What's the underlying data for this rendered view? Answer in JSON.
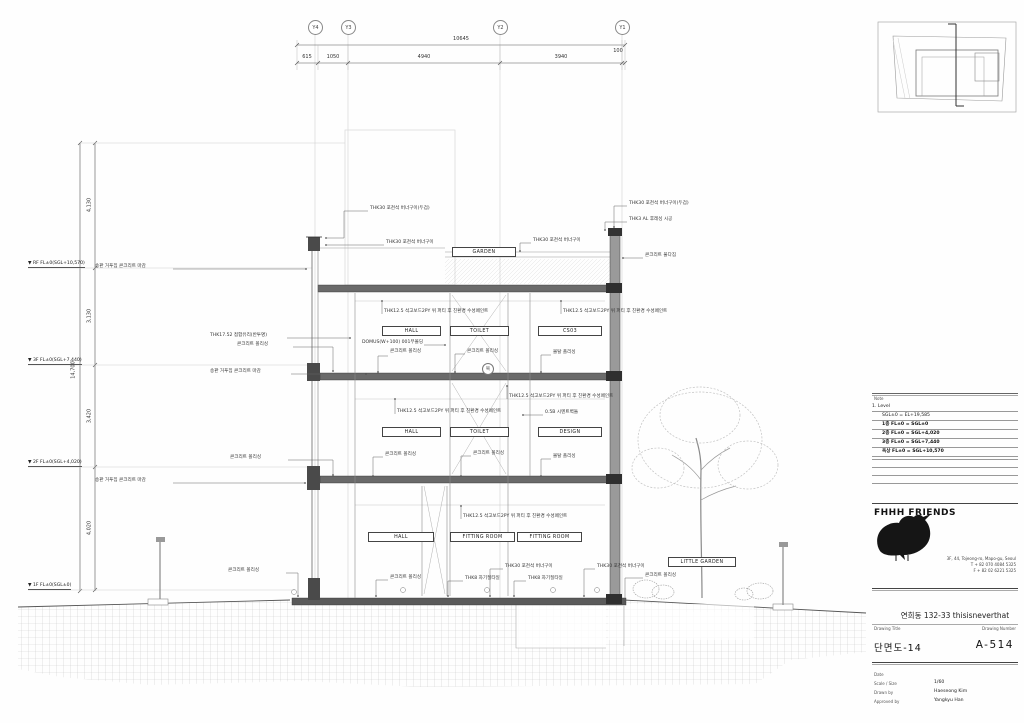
{
  "grid": {
    "bubbles": [
      {
        "x": 315,
        "label": "Y4"
      },
      {
        "x": 348,
        "label": "Y3"
      },
      {
        "x": 500,
        "label": "Y2"
      },
      {
        "x": 622,
        "label": "Y1"
      }
    ]
  },
  "dims": {
    "top": [
      {
        "cx": 461,
        "y": 37,
        "text": "10645"
      },
      {
        "cx": 307,
        "y": 55,
        "text": "615"
      },
      {
        "cx": 333,
        "y": 55,
        "text": "1050"
      },
      {
        "cx": 424,
        "y": 55,
        "text": "4940"
      },
      {
        "cx": 561,
        "y": 55,
        "text": "3940"
      },
      {
        "cx": 618,
        "y": 49,
        "text": "100"
      }
    ],
    "left": [
      {
        "x": 74,
        "cy": 370,
        "text": "14,700"
      },
      {
        "x": 90,
        "cy": 205,
        "text": "4,130"
      },
      {
        "x": 90,
        "cy": 316,
        "text": "3,130"
      },
      {
        "x": 90,
        "cy": 416,
        "text": "3,420"
      },
      {
        "x": 90,
        "cy": 528,
        "text": "4,020"
      }
    ]
  },
  "levels": [
    {
      "y": 268,
      "text": "RF FL±0(SGL+10,570)"
    },
    {
      "y": 365,
      "text": "3F FL±0(SGL+7,440)"
    },
    {
      "y": 467,
      "text": "2F FL±0(SGL+4,020)"
    },
    {
      "y": 590,
      "text": "1F FL±0(SGL±0)"
    }
  ],
  "rooms": [
    {
      "x": 452,
      "y": 247,
      "w": 62,
      "text": "GARDEN"
    },
    {
      "x": 382,
      "y": 326,
      "w": 57,
      "text": "HALL"
    },
    {
      "x": 450,
      "y": 326,
      "w": 57,
      "text": "TOILET"
    },
    {
      "x": 538,
      "y": 326,
      "w": 62,
      "text": "CS03"
    },
    {
      "x": 382,
      "y": 427,
      "w": 57,
      "text": "HALL"
    },
    {
      "x": 450,
      "y": 427,
      "w": 57,
      "text": "TOILET"
    },
    {
      "x": 538,
      "y": 427,
      "w": 62,
      "text": "DESIGN"
    },
    {
      "x": 368,
      "y": 532,
      "w": 64,
      "text": "HALL"
    },
    {
      "x": 450,
      "y": 532,
      "w": 63,
      "text": "FITTING ROOM"
    },
    {
      "x": 517,
      "y": 532,
      "w": 63,
      "text": "FITTING ROOM"
    },
    {
      "x": 668,
      "y": 557,
      "w": 66,
      "text": "LITTLE GARDEN"
    }
  ],
  "annotations": [
    {
      "x": 370,
      "y": 209,
      "text": "THK30 포천석 버너구이(두겁)"
    },
    {
      "x": 386,
      "y": 243,
      "text": "THK30 포천석 버너구이"
    },
    {
      "x": 629,
      "y": 204,
      "text": "THK30 포천석 버너구이(두겁)"
    },
    {
      "x": 629,
      "y": 220,
      "text": "THK3 AL 후레싱 시공"
    },
    {
      "x": 533,
      "y": 241,
      "text": "THK30 포천석 버너구이"
    },
    {
      "x": 645,
      "y": 256,
      "text": "콘크리트 물다짐"
    },
    {
      "x": 384,
      "y": 312,
      "text": "THK12.5 석고보드2PY 위 퍼티 후 친환경 수성페인트"
    },
    {
      "x": 563,
      "y": 312,
      "text": "THK12.5 석고보드2PY 위 퍼티 후 친환경 수성페인트"
    },
    {
      "x": 210,
      "y": 336,
      "text": "THK17.52 접합유리(반투명)"
    },
    {
      "x": 362,
      "y": 343,
      "text": "DOMUS(W+100) 001무몰딩"
    },
    {
      "x": 237,
      "y": 345,
      "text": "콘크리트 폴리싱"
    },
    {
      "x": 390,
      "y": 352,
      "text": "콘크리트 폴리싱"
    },
    {
      "x": 467,
      "y": 352,
      "text": "콘크리트 폴리싱"
    },
    {
      "x": 553,
      "y": 353,
      "text": "몰탈 폴리싱"
    },
    {
      "x": 95,
      "y": 267,
      "text": "송판 거푸집 콘크리트 마감"
    },
    {
      "x": 210,
      "y": 372,
      "text": "송판 거푸집 콘크리트 마감"
    },
    {
      "x": 95,
      "y": 481,
      "text": "송판 거푸집 콘크리트 마감"
    },
    {
      "x": 397,
      "y": 412,
      "text": "THK12.5 석고보드2PY 위 퍼티 후 친환경 수성페인트"
    },
    {
      "x": 509,
      "y": 397,
      "text": "THK12.5 석고보드2PY 위 퍼티 후 친환경 수성페인트"
    },
    {
      "x": 545,
      "y": 413,
      "text": "0.5B 시멘트벽돌"
    },
    {
      "x": 230,
      "y": 458,
      "text": "콘크리트 폴리싱"
    },
    {
      "x": 385,
      "y": 455,
      "text": "콘크리트 폴리싱"
    },
    {
      "x": 473,
      "y": 454,
      "text": "콘크리트 폴리싱"
    },
    {
      "x": 553,
      "y": 457,
      "text": "몰탈 폴리싱"
    },
    {
      "x": 463,
      "y": 517,
      "text": "THK12.5 석고보드2PY 위 퍼티 후 친환경 수성페인트"
    },
    {
      "x": 505,
      "y": 567,
      "text": "THK30 포천석 버너구이"
    },
    {
      "x": 597,
      "y": 567,
      "text": "THK30 포천석 버너구이"
    },
    {
      "x": 465,
      "y": 579,
      "text": "THK8 자기질타일"
    },
    {
      "x": 528,
      "y": 579,
      "text": "THK8 자기질타일"
    },
    {
      "x": 228,
      "y": 571,
      "text": "콘크리트 폴리싱"
    },
    {
      "x": 390,
      "y": 578,
      "text": "콘크리트 폴리싱"
    },
    {
      "x": 645,
      "y": 576,
      "text": "콘크리트 폴리싱"
    }
  ],
  "keynote": {
    "text": "복"
  },
  "notes": {
    "title": "Note",
    "rows": [
      "1. Level",
      "SGL±0 = EL+19,585",
      "1층 FL±0 = SGL±0",
      "2층 FL±0 = SGL+4,020",
      "3층 FL±0 = SGL+7,440",
      "옥상 FL±0 = SGL+10,570"
    ]
  },
  "firm": {
    "name": "FHHH FRIENDS",
    "address": [
      "3F, 44, Tojeong-ro, Mapo-gu, Seoul",
      "T + 82 070 4084 5325",
      "F + 82 02 6221 5325"
    ]
  },
  "project": {
    "name": "연희동 132-33 thisisneverthat"
  },
  "titleblock": {
    "drawing_title_label": "Drawing Title",
    "drawing_number_label": "Drawing Number",
    "drawing_title": "단면도-14",
    "drawing_number": "A-514",
    "date_label": "Date",
    "scale_label": "Scale / Size",
    "scale": "1/60",
    "drawn_label": "Drawn by",
    "drawn": "Haeseong Kim",
    "approved_label": "Approved by",
    "approved": "Yangkyu Han"
  }
}
